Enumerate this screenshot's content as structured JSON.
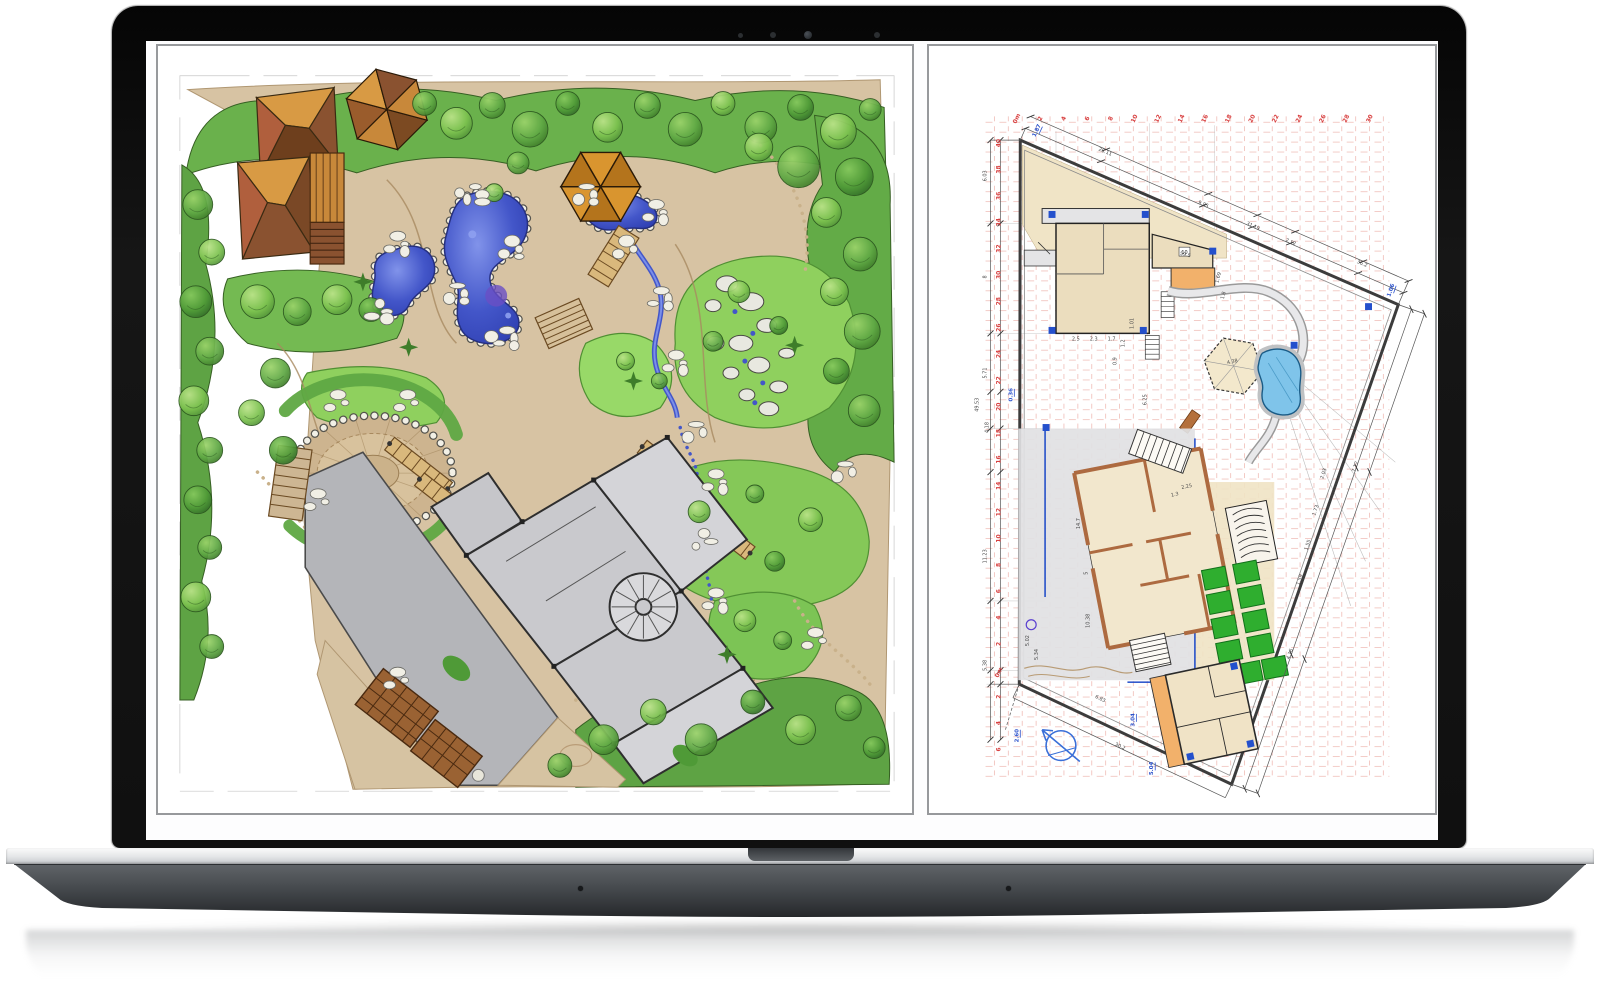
{
  "scene": {
    "type": "laptop-product-mockup",
    "description": "Open laptop displaying a hand-drawn landscape masterplan sketch on the left and the matching CAD site plan with rulers and dimensions on the right",
    "background_color": "#ffffff"
  },
  "laptop": {
    "bezel_color": "#121212",
    "screen_background": "#fdfdfe",
    "base_silver_color": "#e6e7e9",
    "base_body_color": "#3a3e42",
    "camera_dot_count": 4
  },
  "sketch_panel": {
    "title": "landscape-masterplan-sketch",
    "border_color": "#97999c",
    "palette": {
      "ground_tan": "#d7c3a3",
      "tree_green_bright": "#8fd05e",
      "tree_green_mid": "#68b04a",
      "tree_green_dark": "#4f8f33",
      "pond_blue": "#4356c9",
      "pond_violet": "#6a4fc4",
      "roof_orange": "#d89a44",
      "roof_brown": "#6e3f1d",
      "roof_red_brown": "#b05f3d",
      "building_gray": "#c9c9cd",
      "driveway_gray": "#b4b5b9",
      "rock_white": "#f2f0e6"
    },
    "features": [
      "two hip-roof houses",
      "hexagonal-roof house",
      "hexagonal pavilion",
      "rock-edged ponds",
      "wooden bridges",
      "garden stairs",
      "circular plaza",
      "gray residence footprint",
      "diagonal driveway",
      "pergola patio",
      "boulder stream",
      "perimeter tree belts",
      "lawn islands"
    ]
  },
  "cad_panel": {
    "title": "cad-site-plan",
    "border_color": "#97999c",
    "grid_color": "#eaa49c",
    "boundary_color": "#3c3c3c",
    "ruler_color": "#d84040",
    "dimension_text_color": "#4a4a4a",
    "level_text_color": "#2b52cc",
    "fill_colors": {
      "building_beige": "#ecdfc0",
      "terrace_gray": "#e1e1e3",
      "accent_orange": "#f2b16b",
      "pool_blue": "#7fc4ea",
      "bed_green": "#2fae2f",
      "marker_blue": "#2450cc"
    },
    "ruler_top": {
      "first_label": "0m",
      "values": [
        2,
        4,
        6,
        8,
        10,
        12,
        14,
        16,
        18,
        20,
        22,
        24,
        26,
        28,
        30
      ]
    },
    "ruler_left": {
      "values_top_to_bottom": [
        40,
        38,
        36,
        34,
        32,
        30,
        28,
        26,
        24,
        22,
        20,
        18,
        16,
        14,
        12,
        10,
        8,
        6,
        4,
        2
      ],
      "zero_label": "0m",
      "continued_below": [
        2,
        4,
        6
      ]
    },
    "overall_dimensions_left": [
      "6.03",
      "8",
      "5.71",
      "49.53",
      "4.18",
      "11.23",
      "5.38"
    ],
    "dimensions_top_edge": [
      "28.11",
      "9.85",
      "31.19",
      "2.12",
      "36.2"
    ],
    "dimensions_right_edge": [
      "7.12",
      "4.16"
    ],
    "dimensions_bottom_edge": [
      "30.2"
    ],
    "dimensions_inner": [
      "59.5",
      "1.69",
      "1.8",
      "2.5",
      "2.3",
      "1.7",
      "1.01",
      "1.2",
      "0.9",
      "6.25",
      "14.7",
      "5",
      "10.38",
      "5.02",
      "5.34",
      "6.83",
      "2.25",
      "1.3",
      "4.38",
      "2.03",
      "1.73",
      "1.55",
      "1.59"
    ],
    "level_labels": [
      "1.87",
      "1.06",
      "0.36",
      "3.04",
      "5.04",
      "2.60"
    ],
    "room_label": "10",
    "compass": "north-arrow"
  }
}
